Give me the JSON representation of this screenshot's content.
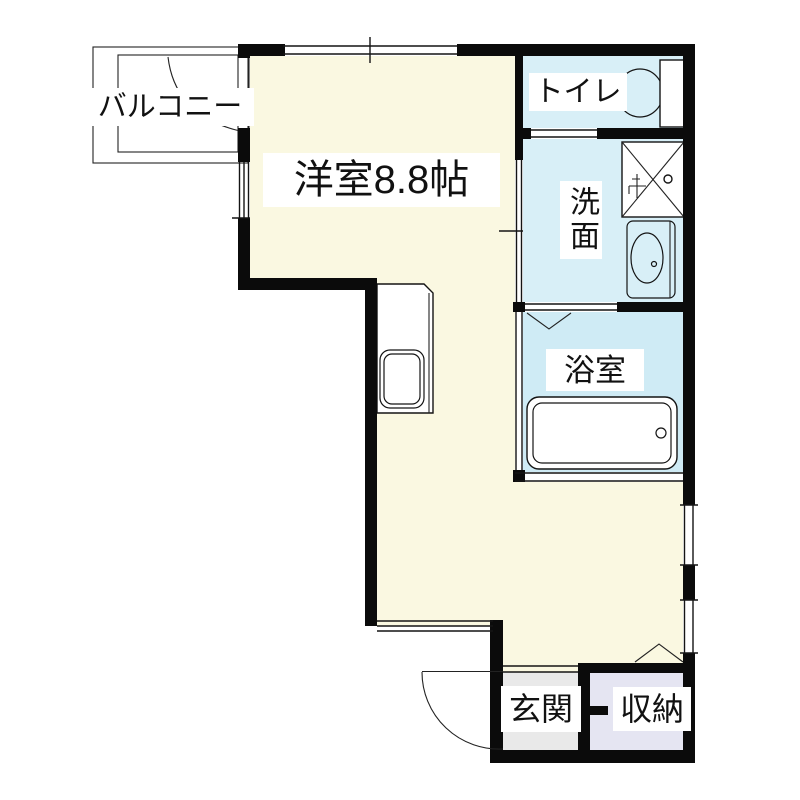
{
  "plan": {
    "type": "apartment-floor-plan",
    "rooms": {
      "western": {
        "label": "洋室8.8帖"
      },
      "balcony": {
        "label": "バルコニー"
      },
      "toilet": {
        "label": "トイレ"
      },
      "washroom": {
        "label": "洗面"
      },
      "bathroom": {
        "label": "浴室"
      },
      "entrance": {
        "label": "玄関"
      },
      "storage": {
        "label": "収納"
      }
    },
    "colors": {
      "main_room_cream": "#FAF8E1",
      "wet_area_blue": "#D8EFF7",
      "bathroom_blue": "#CFEBF5",
      "entrance_gray": "#E9E9E9",
      "storage_lavender": "#E5E5F2",
      "wall_black": "#0B0B0B",
      "background": "#FFFFFF"
    },
    "fixtures": [
      "bathtub",
      "toilet-bowl",
      "toilet-tank",
      "vanity-sink",
      "washing-machine-pan",
      "kitchen-counter-sink",
      "entrance-swing-door",
      "balcony-swing-door",
      "bathroom-folding-door",
      "closet-folding-door",
      "sliding-door",
      "windows"
    ]
  }
}
